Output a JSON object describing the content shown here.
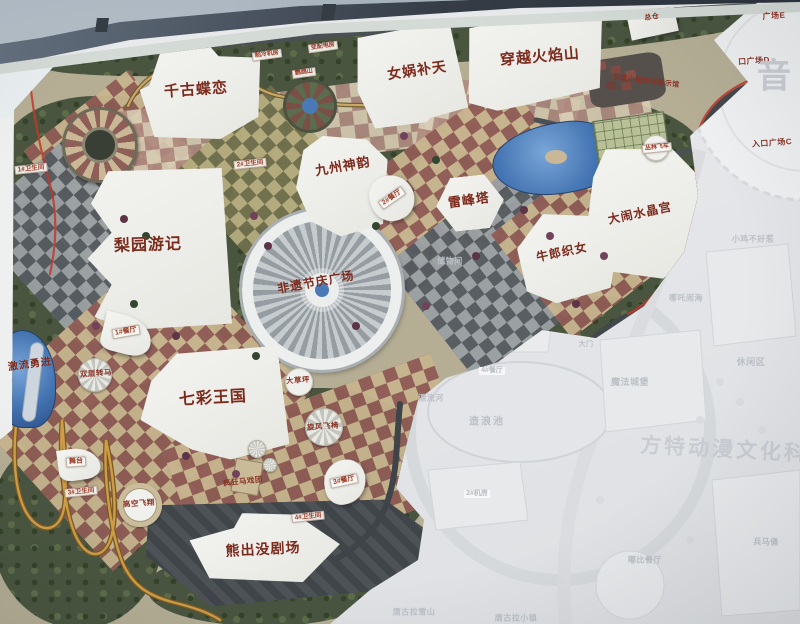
{
  "map_title": "theme-park master plan photo",
  "colors": {
    "accent_red": "#bf3a2b",
    "label_red": "#7c2a1c",
    "ghost_gray": "#bcc0c7",
    "frame": "#353c46"
  },
  "labels": [
    {
      "name": "qiangudielian",
      "text": "千古蝶恋",
      "x": 196,
      "y": 90,
      "fs": 15,
      "type": "major",
      "rot": -4
    },
    {
      "name": "nvwabutian",
      "text": "女娲补天",
      "x": 417,
      "y": 70,
      "fs": 14,
      "type": "major",
      "rot": -8
    },
    {
      "name": "chuanyue-huoyanshan",
      "text": "穿越火焰山",
      "x": 540,
      "y": 57,
      "fs": 15,
      "type": "major",
      "rot": -5
    },
    {
      "name": "zongcang",
      "text": "总仓",
      "x": 652,
      "y": 18,
      "fs": 7,
      "type": "minor-red",
      "rot": -8
    },
    {
      "name": "jiuzhou-shenyun",
      "text": "九州神韵",
      "x": 343,
      "y": 167,
      "fs": 13,
      "type": "major",
      "rot": -10
    },
    {
      "name": "leifengta",
      "text": "雷峰塔",
      "x": 469,
      "y": 201,
      "fs": 13,
      "type": "major",
      "rot": -8
    },
    {
      "name": "niulang-zhinv",
      "text": "牛郎织女",
      "x": 562,
      "y": 253,
      "fs": 12,
      "type": "major",
      "rot": -12
    },
    {
      "name": "danao-shuijinggong",
      "text": "大闹水晶宫",
      "x": 640,
      "y": 214,
      "fs": 12,
      "type": "major",
      "rot": -12
    },
    {
      "name": "liyuan-youji",
      "text": "梨园游记",
      "x": 148,
      "y": 246,
      "fs": 16,
      "type": "major",
      "rot": -2
    },
    {
      "name": "qicai-wangguo",
      "text": "七彩王国",
      "x": 213,
      "y": 399,
      "fs": 16,
      "type": "major",
      "rot": -3
    },
    {
      "name": "xiongchumo-juchang",
      "text": "熊出没剧场",
      "x": 263,
      "y": 549,
      "fs": 14,
      "type": "major",
      "rot": -3
    },
    {
      "name": "feiyi-jieqing-guangchang",
      "text": "非遗节庆广场",
      "x": 316,
      "y": 283,
      "fs": 12,
      "type": "major",
      "rot": -10
    },
    {
      "name": "jiliu-yongjin",
      "text": "激流勇进",
      "x": 30,
      "y": 365,
      "fs": 10,
      "type": "major",
      "rot": -8
    },
    {
      "name": "fengkuang-maxituan",
      "text": "疯狂马戏团",
      "x": 243,
      "y": 482,
      "fs": 7.5,
      "type": "minor-red",
      "rot": -6
    },
    {
      "name": "xuanfeng-feiyi",
      "text": "旋风飞椅",
      "x": 323,
      "y": 427,
      "fs": 7.5,
      "type": "minor-red",
      "rot": -4
    },
    {
      "name": "dacaoping",
      "text": "大草坪",
      "x": 298,
      "y": 381,
      "fs": 7.5,
      "type": "minor-red",
      "rot": -4
    },
    {
      "name": "gaokong-feixiang",
      "text": "高空飞翔",
      "x": 139,
      "y": 504,
      "fs": 7.5,
      "type": "minor-red",
      "rot": -4
    },
    {
      "name": "shuangceng-zhuanma",
      "text": "双层转马",
      "x": 96,
      "y": 374,
      "fs": 7.5,
      "type": "minor-red",
      "rot": -4
    },
    {
      "name": "conglin-feiche",
      "text": "丛林飞车",
      "x": 657,
      "y": 148,
      "fs": 6,
      "type": "tag",
      "rot": -6
    },
    {
      "name": "wutai",
      "text": "舞台",
      "x": 76,
      "y": 462,
      "fs": 7,
      "type": "tag",
      "rot": -4
    },
    {
      "name": "canting-1",
      "text": "1#餐厅",
      "x": 126,
      "y": 332,
      "fs": 7,
      "type": "tag",
      "rot": -10
    },
    {
      "name": "canting-2",
      "text": "2#餐厅",
      "x": 392,
      "y": 198,
      "fs": 7,
      "type": "tag",
      "rot": -35
    },
    {
      "name": "canting-3",
      "text": "3#餐厅",
      "x": 344,
      "y": 481,
      "fs": 7,
      "type": "tag",
      "rot": -12
    },
    {
      "name": "weishengjian-1",
      "text": "1#卫生间",
      "x": 31,
      "y": 169,
      "fs": 6.5,
      "type": "tag",
      "rot": -6
    },
    {
      "name": "weishengjian-2",
      "text": "2#卫生间",
      "x": 250,
      "y": 164,
      "fs": 6.5,
      "type": "tag",
      "rot": -6
    },
    {
      "name": "weishengjian-3",
      "text": "3#卫生间",
      "x": 81,
      "y": 492,
      "fs": 6.5,
      "type": "tag",
      "rot": -6
    },
    {
      "name": "weishengjian-4",
      "text": "4#卫生间",
      "x": 308,
      "y": 517,
      "fs": 6.5,
      "type": "tag",
      "rot": -6
    },
    {
      "name": "zhileng-jifang",
      "text": "制冷机房",
      "x": 267,
      "y": 55,
      "fs": 6,
      "type": "tag",
      "rot": -8
    },
    {
      "name": "bianpeidian-fang",
      "text": "变配电房",
      "x": 323,
      "y": 47,
      "fs": 6,
      "type": "tag",
      "rot": -8
    },
    {
      "name": "yingwushan",
      "text": "鹦鹉山",
      "x": 304,
      "y": 73,
      "fs": 6,
      "type": "tag",
      "rot": -8
    },
    {
      "name": "feiyi-xiaozhen-zhanshiguan",
      "text": "非遗小镇规划展示馆",
      "x": 646,
      "y": 82,
      "fs": 7,
      "type": "minor-red",
      "rot": 7
    },
    {
      "name": "guangchang-e",
      "text": "广场E",
      "x": 774,
      "y": 16,
      "fs": 8,
      "type": "minor-red",
      "rot": -4
    },
    {
      "name": "rukou-guangchang-d",
      "text": "口广场D",
      "x": 754,
      "y": 61,
      "fs": 8,
      "type": "minor-red",
      "rot": -4
    },
    {
      "name": "rukou-guangchang-c",
      "text": "入口广场C",
      "x": 772,
      "y": 143,
      "fs": 8,
      "type": "minor-red",
      "rot": -4
    },
    {
      "name": "yin-watermark",
      "text": "音",
      "x": 774,
      "y": 77,
      "fs": 34,
      "type": "ghost-big",
      "rot": 0
    },
    {
      "name": "fangte-watermark",
      "text": "方特动漫文化科技",
      "x": 736,
      "y": 451,
      "fs": 21,
      "type": "ghost-big",
      "rot": 3,
      "ls": 3
    },
    {
      "name": "chuwujian",
      "text": "储物间",
      "x": 450,
      "y": 261,
      "fs": 8,
      "type": "ghost"
    },
    {
      "name": "xiaoji-buhaore",
      "text": "小鸡不好惹",
      "x": 753,
      "y": 239,
      "fs": 8,
      "type": "ghost"
    },
    {
      "name": "nezha-naohai",
      "text": "哪吒闹海",
      "x": 686,
      "y": 298,
      "fs": 8,
      "type": "ghost"
    },
    {
      "name": "mofa-chengbao",
      "text": "魔法城堡",
      "x": 630,
      "y": 382,
      "fs": 9,
      "type": "ghost"
    },
    {
      "name": "xiuxianqu",
      "text": "休闲区",
      "x": 751,
      "y": 362,
      "fs": 9,
      "type": "ghost"
    },
    {
      "name": "zaolangchi",
      "text": "造浪池",
      "x": 487,
      "y": 422,
      "fs": 10,
      "type": "ghost",
      "ls": 2
    },
    {
      "name": "piaoliuhe",
      "text": "漂流河",
      "x": 431,
      "y": 398,
      "fs": 8,
      "type": "ghost"
    },
    {
      "name": "canting-4",
      "text": "4#餐厅",
      "x": 492,
      "y": 371,
      "fs": 7,
      "type": "ghost-tag"
    },
    {
      "name": "damen",
      "text": "大门",
      "x": 586,
      "y": 345,
      "fs": 7,
      "type": "ghost"
    },
    {
      "name": "jifang-2",
      "text": "2#机房",
      "x": 477,
      "y": 494,
      "fs": 7,
      "type": "ghost-tag"
    },
    {
      "name": "tanggula-xueshan",
      "text": "唐古拉雪山",
      "x": 414,
      "y": 612,
      "fs": 8,
      "type": "ghost"
    },
    {
      "name": "tanggula-xiaozhen",
      "text": "唐古拉小镇",
      "x": 516,
      "y": 618,
      "fs": 8,
      "type": "ghost"
    },
    {
      "name": "dubi-canting",
      "text": "嘟比餐厅",
      "x": 645,
      "y": 560,
      "fs": 8,
      "type": "ghost"
    },
    {
      "name": "bingmayong",
      "text": "兵马俑",
      "x": 766,
      "y": 542,
      "fs": 8,
      "type": "ghost"
    }
  ]
}
